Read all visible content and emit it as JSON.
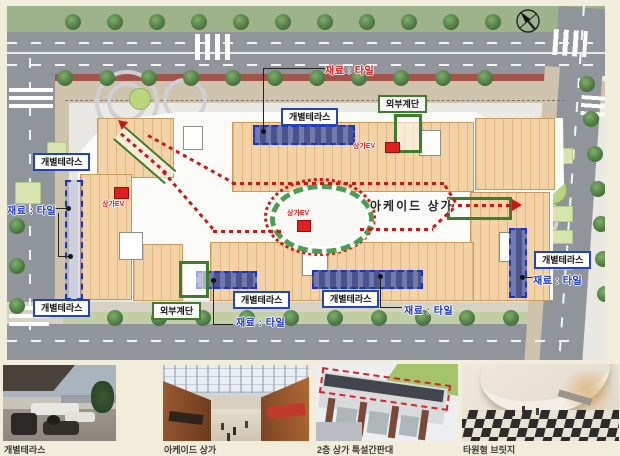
{
  "plan": {
    "arcade_label": "아케이드 상가",
    "ev_label": "상가EV",
    "material_label": "재료 : 타일",
    "terrace_label": "개별테라스",
    "stairs_label": "외부계단"
  },
  "photos": [
    {
      "caption": "개별테라스"
    },
    {
      "caption": "아케이드 상가"
    },
    {
      "caption": "2층 상가 특설간판대"
    },
    {
      "caption": "타원형 브릿지"
    }
  ],
  "colors": {
    "terrace_accent": "#2244bb",
    "stairs_accent": "#3d7d2d",
    "route_red": "#d01515",
    "material_blue": "#1733cf",
    "room_fill": "#f3d2a6",
    "road_gray": "#8f959b"
  }
}
